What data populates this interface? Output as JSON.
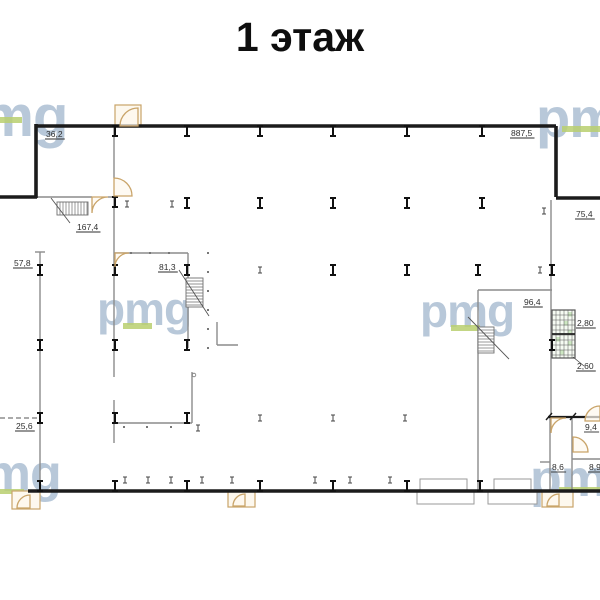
{
  "title": "1 этаж",
  "watermark": {
    "text": "pmg",
    "color": "#b5c6d8",
    "underline_color": "#b8cf6e",
    "instances": [
      {
        "x": -52,
        "y": 88,
        "fs": 58,
        "bar": {
          "x": 0,
          "y": 117,
          "w": 22,
          "h": 6
        }
      },
      {
        "x": 536,
        "y": 90,
        "fs": 56,
        "bar": {
          "x": 562,
          "y": 126,
          "w": 38,
          "h": 6
        }
      },
      {
        "x": 97,
        "y": 286,
        "fs": 46,
        "bar": {
          "x": 123,
          "y": 323,
          "w": 29,
          "h": 6
        }
      },
      {
        "x": 420,
        "y": 288,
        "fs": 46,
        "bar": {
          "x": 451,
          "y": 325,
          "w": 29,
          "h": 6
        }
      },
      {
        "x": -46,
        "y": 448,
        "fs": 52,
        "bar": {
          "x": 0,
          "y": 489,
          "w": 24,
          "h": 5
        }
      },
      {
        "x": 530,
        "y": 453,
        "fs": 52,
        "bar": {
          "x": 559,
          "y": 487,
          "w": 41,
          "h": 5
        }
      }
    ]
  },
  "plan": {
    "colors": {
      "wall": "#1b1b1b",
      "thin": "#8c8c8c",
      "door": "#c9a469",
      "door_fill": "#fdf8ee",
      "label": "#2e2e2e",
      "hatch": "#6e6e6e",
      "shaft_fill": "#cde7c2",
      "dot": "#777777"
    },
    "area_labels": [
      {
        "text": "36,2",
        "x": 46,
        "y": 137
      },
      {
        "text": "887,5",
        "x": 511,
        "y": 136
      },
      {
        "text": "167,4",
        "x": 77,
        "y": 230
      },
      {
        "text": "57,8",
        "x": 14,
        "y": 266
      },
      {
        "text": "81,3",
        "x": 159,
        "y": 270
      },
      {
        "text": "96,4",
        "x": 524,
        "y": 305
      },
      {
        "text": "25,6",
        "x": 16,
        "y": 429
      },
      {
        "text": "75,4",
        "x": 576,
        "y": 217
      },
      {
        "text": "2,80",
        "x": 577,
        "y": 326
      },
      {
        "text": "2,60",
        "x": 577,
        "y": 369
      },
      {
        "text": "9,4",
        "x": 585,
        "y": 430
      },
      {
        "text": "8,6",
        "x": 552,
        "y": 470
      },
      {
        "text": "8,9",
        "x": 589,
        "y": 470
      }
    ],
    "walls_thick": [
      [
        36,
        126,
        556,
        126
      ],
      [
        36,
        124,
        36,
        198
      ],
      [
        0,
        197,
        37,
        197
      ],
      [
        556,
        126,
        556,
        197
      ],
      [
        556,
        198,
        600,
        198
      ],
      [
        28,
        491,
        600,
        491
      ]
    ],
    "walls_thin": [
      [
        114,
        126,
        114,
        178
      ],
      [
        114,
        196,
        114,
        377
      ],
      [
        114,
        400,
        114,
        443
      ],
      [
        40,
        252,
        40,
        490
      ],
      [
        35,
        252,
        45,
        252
      ],
      [
        36,
        197,
        92,
        197
      ],
      [
        108,
        197,
        114,
        197
      ],
      [
        114,
        253,
        188,
        253
      ],
      [
        188,
        253,
        188,
        348
      ],
      [
        114,
        423,
        192,
        423
      ],
      [
        192,
        372,
        192,
        423
      ],
      [
        478,
        290,
        552,
        290
      ],
      [
        478,
        290,
        478,
        490
      ],
      [
        551,
        200,
        551,
        415
      ],
      [
        572,
        459,
        600,
        459
      ],
      [
        572,
        418,
        572,
        490
      ],
      [
        540,
        462,
        550,
        462
      ],
      [
        550,
        418,
        550,
        490
      ],
      [
        217,
        322,
        217,
        345
      ],
      [
        217,
        345,
        238,
        345
      ]
    ],
    "paths_thin": [
      "M186 307 A16 16 0 0 0 202 293"
    ],
    "dashed": [
      [
        0,
        418,
        38,
        418
      ]
    ],
    "dim": {
      "line": [
        548,
        417,
        600,
        417
      ],
      "ticks": [
        [
          546,
          420,
          552,
          413
        ],
        [
          570,
          420,
          576,
          413
        ]
      ]
    },
    "columns_big": [
      [
        115,
        131
      ],
      [
        187,
        131
      ],
      [
        260,
        131
      ],
      [
        333,
        131
      ],
      [
        407,
        131
      ],
      [
        482,
        131
      ],
      [
        115,
        202
      ],
      [
        187,
        203
      ],
      [
        260,
        203
      ],
      [
        333,
        203
      ],
      [
        407,
        203
      ],
      [
        482,
        203
      ],
      [
        40,
        270
      ],
      [
        115,
        270
      ],
      [
        187,
        270
      ],
      [
        333,
        270
      ],
      [
        407,
        270
      ],
      [
        478,
        270
      ],
      [
        552,
        270
      ],
      [
        40,
        345
      ],
      [
        115,
        345
      ],
      [
        187,
        345
      ],
      [
        552,
        345
      ],
      [
        40,
        418
      ],
      [
        115,
        418
      ],
      [
        187,
        418
      ],
      [
        40,
        486
      ],
      [
        115,
        486
      ],
      [
        187,
        486
      ],
      [
        260,
        486
      ],
      [
        333,
        486
      ],
      [
        407,
        486
      ],
      [
        480,
        486
      ]
    ],
    "columns_small": [
      [
        127,
        204
      ],
      [
        172,
        204
      ],
      [
        544,
        211
      ],
      [
        260,
        270
      ],
      [
        540,
        270
      ],
      [
        198,
        428
      ],
      [
        260,
        418
      ],
      [
        333,
        418
      ],
      [
        405,
        418
      ],
      [
        125,
        480
      ],
      [
        148,
        480
      ],
      [
        171,
        480
      ],
      [
        202,
        480
      ],
      [
        232,
        480
      ],
      [
        315,
        480
      ],
      [
        350,
        480
      ],
      [
        390,
        480
      ]
    ],
    "dots": [
      [
        208,
        253
      ],
      [
        208,
        272
      ],
      [
        208,
        291
      ],
      [
        208,
        310
      ],
      [
        208,
        329
      ],
      [
        208,
        348
      ],
      [
        124,
        427
      ],
      [
        147,
        427
      ],
      [
        171,
        427
      ],
      [
        131,
        253
      ],
      [
        150,
        253
      ],
      [
        169,
        253
      ]
    ],
    "rings": [
      [
        194,
        375
      ]
    ],
    "stairs": [
      {
        "x": 57,
        "y": 202,
        "w": 31,
        "h": 13,
        "dir": "v",
        "step": 3,
        "diag": [
          51,
          198,
          70,
          223
        ]
      },
      {
        "x": 186,
        "y": 278,
        "w": 17,
        "h": 29,
        "dir": "h",
        "step": 3,
        "diag": [
          179,
          270,
          209,
          316
        ]
      },
      {
        "x": 478,
        "y": 327,
        "w": 16,
        "h": 26,
        "dir": "h",
        "step": 3,
        "diag": [
          468,
          317,
          509,
          359
        ]
      }
    ],
    "door_frames": [
      [
        115,
        105,
        26,
        22
      ],
      [
        12,
        491,
        28,
        18
      ],
      [
        228,
        491,
        27,
        16
      ],
      [
        542,
        491,
        31,
        16
      ]
    ],
    "doors": [
      "M120 126 A18 18 0 0 1 138 108 L138 126 Z",
      "M114 178 A18 18 0 0 1 132 196 L114 196 Z",
      "M108 197 A16 16 0 0 0 92 213 L92 197 Z",
      "M115 267 A14 14 0 0 1 129 253 L115 253 Z",
      "M17 508 A13 13 0 0 1 30 495 L30 508 Z",
      "M233 506 A12 12 0 0 1 245 494 L245 506 Z",
      "M547 506 A12 12 0 0 1 559 494 L559 506 Z",
      "M585 421 A15 15 0 0 1 600 406 L600 421 Z",
      "M566 418 A15 15 0 0 0 551 433 L551 418 Z",
      "M573 437 A15 15 0 0 1 588 452 L573 452 Z"
    ],
    "windows": [
      [
        420,
        479,
        47,
        12
      ],
      [
        494,
        479,
        37,
        12
      ],
      [
        417,
        492,
        57,
        12
      ],
      [
        488,
        492,
        49,
        12
      ]
    ],
    "shaft": {
      "x": 552,
      "y": 310,
      "w": 23,
      "h": 48,
      "div_y": 334,
      "green_cells": [
        [
          568,
          312
        ],
        [
          564,
          321
        ],
        [
          568,
          330
        ],
        [
          556,
          337
        ],
        [
          568,
          341
        ],
        [
          560,
          350
        ]
      ],
      "leader": [
        573,
        357,
        584,
        366
      ]
    }
  }
}
